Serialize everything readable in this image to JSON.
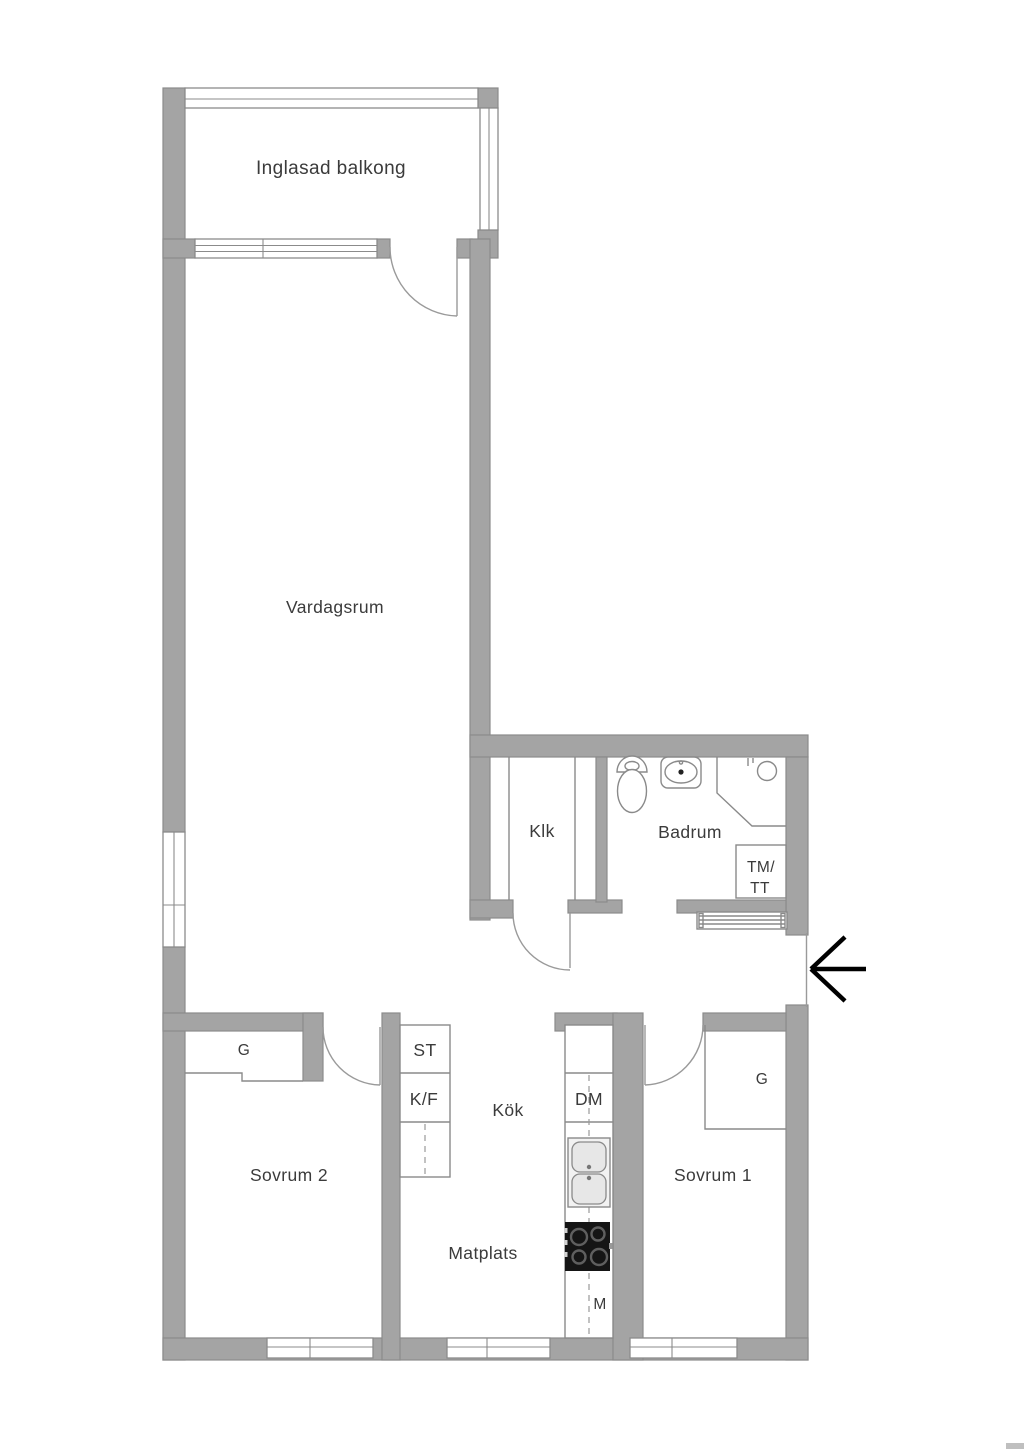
{
  "floorplan": {
    "rooms": {
      "balcony": "Inglasad balkong",
      "living_room": "Vardagsrum",
      "hall_closet": "Klk",
      "bathroom": "Badrum",
      "kitchen": "Kök",
      "dining_area": "Matplats",
      "bedroom_1": "Sovrum 1",
      "bedroom_2": "Sovrum 2"
    },
    "appliances": {
      "washer_line1": "TM/",
      "washer_line2": "TT",
      "wardrobe_bedroom2": "G",
      "wardrobe_bedroom1": "G",
      "cleaning_cabinet": "ST",
      "fridge_freezer": "K/F",
      "dishwasher": "DM",
      "microwave": "M"
    },
    "colors": {
      "wall": "#a4a4a4",
      "background": "#ffffff",
      "line": "#8a8a8a",
      "text": "#3b3b3b",
      "stove": "#151515"
    }
  }
}
